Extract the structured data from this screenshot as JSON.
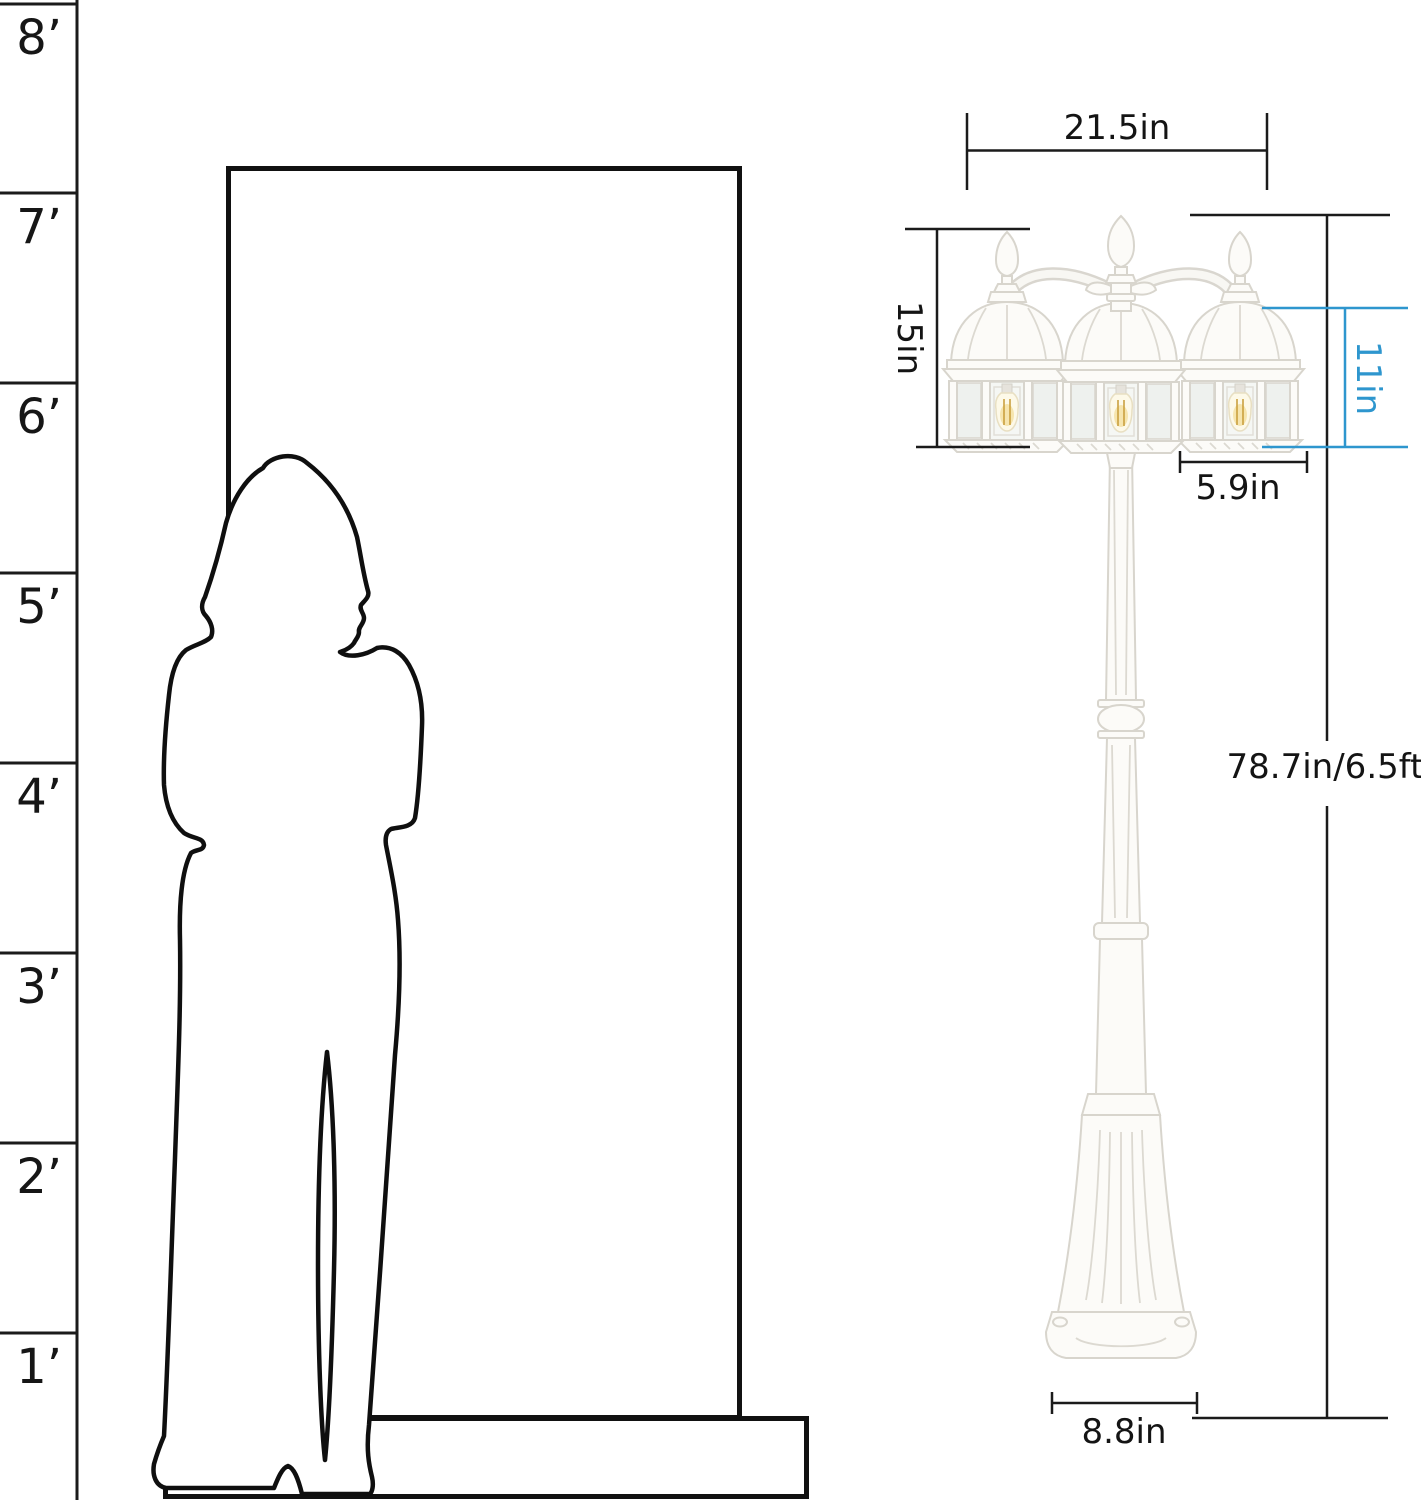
{
  "page": {
    "background": "#ffffff",
    "width": 1421,
    "height": 1500
  },
  "ruler": {
    "marks": [
      {
        "label": "8’"
      },
      {
        "label": "7’"
      },
      {
        "label": "6’"
      },
      {
        "label": "5’"
      },
      {
        "label": "4’"
      },
      {
        "label": "3’"
      },
      {
        "label": "2’"
      },
      {
        "label": "1’"
      }
    ]
  },
  "dimensions": {
    "head_width": {
      "label": "21.5in"
    },
    "lantern_assembly_height": {
      "label": "15in"
    },
    "single_lantern_height": {
      "label": "11in",
      "color": "#2E96CE"
    },
    "single_lantern_width": {
      "label": "5.9in"
    },
    "total_height": {
      "label": "78.7in/6.5ft"
    },
    "base_width": {
      "label": "8.8in"
    }
  },
  "colors": {
    "dimension_line": "#1b1b1b",
    "accent_blue": "#2E96CE",
    "lamp_body": "#fcfbf8",
    "bulb_glow": "#f6e5ae"
  }
}
